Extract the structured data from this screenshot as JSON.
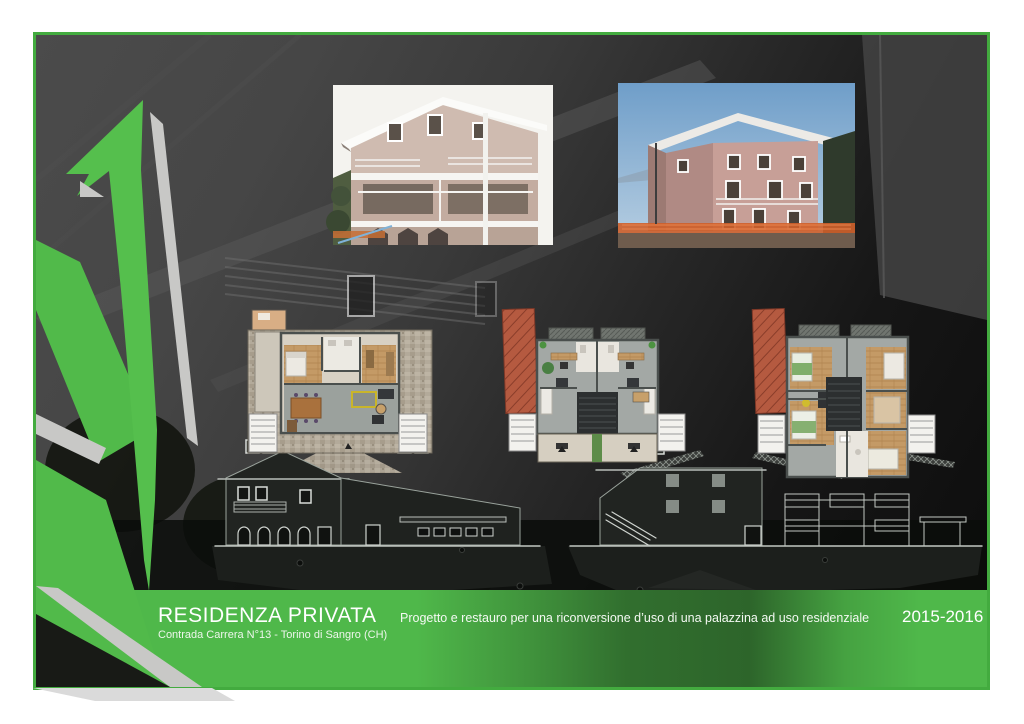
{
  "palette": {
    "accent_green": "#4fb84a",
    "frame_border_green": "#43ab3f",
    "shadow_gray": "#c8c8c6",
    "photo_backdrop_dark": "#2c2c2c"
  },
  "footer": {
    "title": "RESIDENZA PRIVATA",
    "subtitle": "Contrada Carrera N°13 - Torino di Sangro (CH)",
    "description": "Progetto e restauro per una riconversione d’uso di una palazzina ad uso residenziale",
    "years": "2015-2016"
  },
  "figures": {
    "photo_left": "building-exterior-photo-front",
    "photo_right": "building-exterior-photo-rear",
    "plan_1": "ground-floor-plan",
    "plan_2": "first-floor-plan",
    "plan_3": "second-floor-plan",
    "elevation": "street-elevation-line-drawing",
    "graphic": "green-arrow-brand-graphic"
  }
}
